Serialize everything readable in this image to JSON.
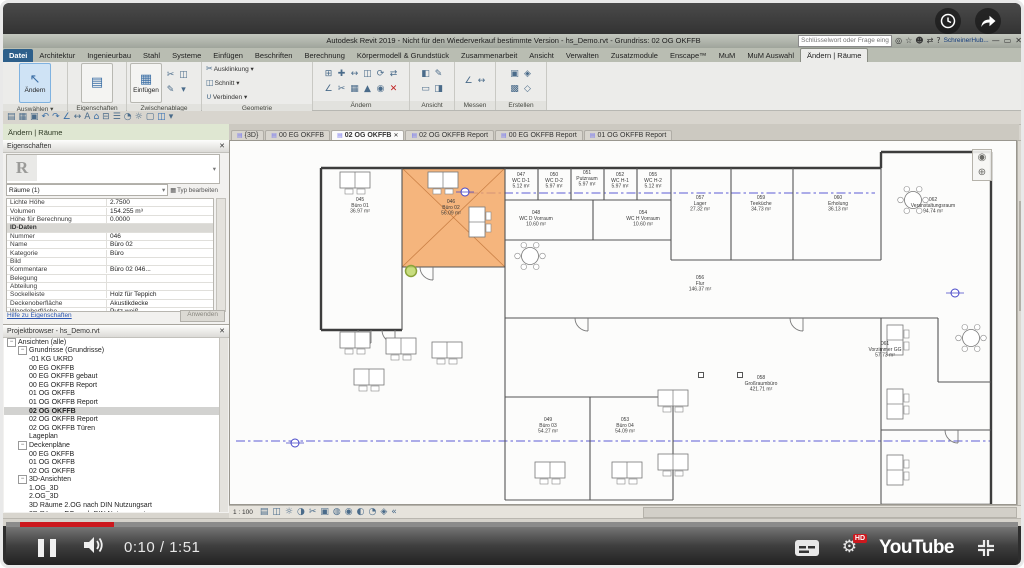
{
  "player": {
    "time": "0:10 / 1:51",
    "brand": "YouTube",
    "hd": "HD",
    "accent": "#cc181e",
    "progress_px": 94
  },
  "titlebar": {
    "title": "Autodesk Revit 2019 - Nicht für den Wiederverkauf bestimmte Version - hs_Demo.rvt - Grundriss: 02 OG OKFFB",
    "search_placeholder": "Schlüsselwort oder Frage eingeben",
    "account_label": "SchreinerHub...",
    "icons": [
      {
        "name": "search-binoculars-icon",
        "glyph": "◎"
      },
      {
        "name": "favorites-icon",
        "glyph": "☆"
      },
      {
        "name": "sign-in-icon",
        "glyph": "☻"
      },
      {
        "name": "cart-icon",
        "glyph": "⇄"
      },
      {
        "name": "help-icon",
        "glyph": "?"
      }
    ],
    "window_controls": [
      {
        "name": "minimize-icon",
        "glyph": "—"
      },
      {
        "name": "restore-icon",
        "glyph": "▭"
      },
      {
        "name": "close-icon",
        "glyph": "✕"
      }
    ]
  },
  "ribbon": {
    "tabs": [
      "Datei",
      "Architektur",
      "Ingenieurbau",
      "Stahl",
      "Systeme",
      "Einfügen",
      "Beschriften",
      "Berechnung",
      "Körpermodell & Grundstück",
      "Zusammenarbeit",
      "Ansicht",
      "Verwalten",
      "Zusatzmodule",
      "Enscape™",
      "MuM",
      "MuM Auswahl",
      "Ändern | Räume"
    ],
    "file_tab": "Datei",
    "active_tab": "Ändern | Räume",
    "big_modify": "Ändern",
    "big_paste": "Einfügen",
    "panel_labels": {
      "select": "Auswählen ▾",
      "properties": "Eigenschaften",
      "clipboard": "Zwischenablage",
      "geometry": "Geometrie",
      "modify": "Ändern",
      "view": "Ansicht",
      "measure": "Messen",
      "create": "Erstellen"
    },
    "geometrie_rows": [
      {
        "glyph": "✂",
        "label": "Ausklinkung ▾"
      },
      {
        "glyph": "◫",
        "label": "Schnitt ▾"
      },
      {
        "glyph": "∪",
        "label": "Verbinden ▾"
      }
    ]
  },
  "qat_icons": [
    {
      "name": "open-icon",
      "glyph": "▤"
    },
    {
      "name": "save-icon",
      "glyph": "▦"
    },
    {
      "name": "print-icon",
      "glyph": "▣"
    },
    {
      "name": "undo-icon",
      "glyph": "↶",
      "color": "#3a6ea5"
    },
    {
      "name": "redo-icon",
      "glyph": "↷",
      "color": "#3a6ea5"
    },
    {
      "name": "measure-icon",
      "glyph": "∠",
      "color": "#3a6ea5"
    },
    {
      "name": "aligned-dimension-icon",
      "glyph": "↔"
    },
    {
      "name": "text-icon",
      "glyph": "A"
    },
    {
      "name": "default-3d-view-icon",
      "glyph": "⌂",
      "color": "#3a6ea5"
    },
    {
      "name": "section-icon",
      "glyph": "⊟"
    },
    {
      "name": "thin-lines-icon",
      "glyph": "☰"
    },
    {
      "name": "render-icon",
      "glyph": "◔"
    },
    {
      "name": "sun-icon",
      "glyph": "☼"
    },
    {
      "name": "close-inactive-icon",
      "glyph": "▢"
    },
    {
      "name": "switch-windows-icon",
      "glyph": "◫",
      "color": "#2d6cb4"
    },
    {
      "name": "user-interface-icon",
      "glyph": "▾"
    }
  ],
  "zwischenablage_icons": [
    {
      "name": "cut-icon",
      "glyph": "✂"
    },
    {
      "name": "copy-to-clipboard-icon",
      "glyph": "◫"
    },
    {
      "name": "match-type-icon",
      "glyph": "✎"
    },
    {
      "name": "paste-options-icon",
      "glyph": "▾"
    }
  ],
  "modify_icons": [
    {
      "name": "align-icon",
      "glyph": "⊞"
    },
    {
      "name": "move-icon",
      "glyph": "✚"
    },
    {
      "name": "offset-icon",
      "glyph": "↔"
    },
    {
      "name": "copy-icon",
      "glyph": "◫"
    },
    {
      "name": "rotate-icon",
      "glyph": "⟳"
    },
    {
      "name": "mirror-icon",
      "glyph": "⇄"
    },
    {
      "name": "trim-icon",
      "glyph": "∠"
    },
    {
      "name": "split-icon",
      "glyph": "✂"
    },
    {
      "name": "array-icon",
      "glyph": "▦"
    },
    {
      "name": "scale-icon",
      "glyph": "▲"
    },
    {
      "name": "pin-icon",
      "glyph": "◉"
    },
    {
      "name": "delete-icon",
      "glyph": "✕",
      "color": "#c02020"
    }
  ],
  "ansicht_icons": [
    {
      "name": "wireframe-icon",
      "glyph": "◧"
    },
    {
      "name": "linework-icon",
      "glyph": "✎"
    },
    {
      "name": "callout-icon",
      "glyph": "▭"
    },
    {
      "name": "view-range-icon",
      "glyph": "◨"
    }
  ],
  "messen_icons": [
    {
      "name": "measure-between-icon",
      "glyph": "∠"
    },
    {
      "name": "dimension-icon",
      "glyph": "↔"
    }
  ],
  "erstellen_icons": [
    {
      "name": "create-group-icon",
      "glyph": "▣"
    },
    {
      "name": "create-similar-icon",
      "glyph": "◈"
    },
    {
      "name": "create-assembly-icon",
      "glyph": "▩"
    },
    {
      "name": "create-parts-icon",
      "glyph": "◇"
    }
  ],
  "options_label": "Ändern | Räume",
  "properties": {
    "header": "Eigenschaften",
    "selector_value": "Räume (1)",
    "edit_type_label": "Typ bearbeiten",
    "rows": [
      {
        "label": "Lichte Höhe",
        "value": "2.7500"
      },
      {
        "label": "Volumen",
        "value": "154.255 m³"
      },
      {
        "label": "Höhe für Berechnung",
        "value": "0.0000"
      },
      {
        "section": "ID-Daten"
      },
      {
        "label": "Nummer",
        "value": "046"
      },
      {
        "label": "Name",
        "value": "Büro 02"
      },
      {
        "label": "Kategorie",
        "value": "Büro"
      },
      {
        "label": "Bild",
        "value": ""
      },
      {
        "label": "Kommentare",
        "value": "Büro 02 046..."
      },
      {
        "label": "Belegung",
        "value": ""
      },
      {
        "label": "Abteilung",
        "value": ""
      },
      {
        "label": "Sockelleiste",
        "value": "Holz für Teppich"
      },
      {
        "label": "Deckenoberfläche",
        "value": "Akustikdecke"
      },
      {
        "label": "Wandoberfläche",
        "value": "Putz weiß"
      },
      {
        "label": "Fußboden",
        "value": "Teppich"
      }
    ],
    "help_link": "Hilfe zu Eigenschaften",
    "apply_label": "Anwenden"
  },
  "project_browser": {
    "header": "Projektbrowser - hs_Demo.rvt",
    "items": [
      {
        "label": "Ansichten (alle)",
        "depth": 0,
        "toggle": true
      },
      {
        "label": "Grundrisse (Grundrisse)",
        "depth": 1,
        "toggle": true
      },
      {
        "label": "-01 KG UKRD",
        "depth": 2
      },
      {
        "label": "00 EG OKFFB",
        "depth": 2
      },
      {
        "label": "00 EG OKFFB gebaut",
        "depth": 2
      },
      {
        "label": "00 EG OKFFB Report",
        "depth": 2
      },
      {
        "label": "01 OG OKFFB",
        "depth": 2
      },
      {
        "label": "01 OG OKFFB Report",
        "depth": 2
      },
      {
        "label": "02 OG OKFFB",
        "depth": 2,
        "selected": true
      },
      {
        "label": "02 OG OKFFB Report",
        "depth": 2
      },
      {
        "label": "02 OG OKFFB Türen",
        "depth": 2
      },
      {
        "label": "Lageplan",
        "depth": 2
      },
      {
        "label": "Deckenpläne",
        "depth": 1,
        "toggle": true
      },
      {
        "label": "00 EG OKFFB",
        "depth": 2
      },
      {
        "label": "01 OG OKFFB",
        "depth": 2
      },
      {
        "label": "02 OG OKFFB",
        "depth": 2
      },
      {
        "label": "3D-Ansichten",
        "depth": 1,
        "toggle": true
      },
      {
        "label": "1.OG_3D",
        "depth": 2
      },
      {
        "label": "2.OG_3D",
        "depth": 2
      },
      {
        "label": "3D Räume 2.OG  nach DIN Nutzungsart",
        "depth": 2
      },
      {
        "label": "3D Räume EG  nach DIN Nutzungsart",
        "depth": 2
      }
    ]
  },
  "view_tabs": {
    "close_glyph": "✕",
    "items": [
      {
        "label": "{3D}"
      },
      {
        "label": "00 EG OKFFB"
      },
      {
        "label": "02 OG OKFFB",
        "active": true
      },
      {
        "label": "02 OG OKFFB Report"
      },
      {
        "label": "00 EG OKFFB Report"
      },
      {
        "label": "01 OG OKFFB Report"
      }
    ]
  },
  "canvas": {
    "scale_label": "1 : 100"
  },
  "view_icons": [
    {
      "name": "detail-level-icon",
      "glyph": "▤"
    },
    {
      "name": "visual-style-icon",
      "glyph": "◫"
    },
    {
      "name": "sun-path-icon",
      "glyph": "☼"
    },
    {
      "name": "shadows-icon",
      "glyph": "◑"
    },
    {
      "name": "crop-view-icon",
      "glyph": "✂"
    },
    {
      "name": "show-crop-icon",
      "glyph": "▣"
    },
    {
      "name": "temporary-hide-icon",
      "glyph": "◍"
    },
    {
      "name": "reveal-hidden-icon",
      "glyph": "◉"
    },
    {
      "name": "worksharing-display-icon",
      "glyph": "◐"
    },
    {
      "name": "temporary-view-icon",
      "glyph": "◔"
    },
    {
      "name": "analysis-icon",
      "glyph": "◈"
    },
    {
      "name": "constraints-icon",
      "glyph": "«"
    }
  ],
  "nav_icons": [
    {
      "name": "steering-wheel-icon",
      "glyph": "◉"
    },
    {
      "name": "zoom-tool-icon",
      "glyph": "⊕"
    }
  ],
  "plan": {
    "highlight": {
      "x": 399,
      "y": 168,
      "w": 103,
      "h": 99
    },
    "walls_outer": [
      [
        318,
        168,
        878,
        168
      ],
      [
        878,
        152,
        878,
        168
      ],
      [
        878,
        152,
        988,
        152
      ],
      [
        988,
        152,
        988,
        505
      ],
      [
        318,
        168,
        318,
        330
      ],
      [
        318,
        330,
        399,
        330
      ],
      [
        878,
        505,
        988,
        505
      ]
    ],
    "walls_inner": [
      [
        399,
        168,
        399,
        330
      ],
      [
        502,
        168,
        502,
        318
      ],
      [
        399,
        267,
        502,
        267
      ],
      [
        535,
        168,
        535,
        200
      ],
      [
        568,
        168,
        568,
        200
      ],
      [
        601,
        168,
        601,
        200
      ],
      [
        634,
        168,
        634,
        200
      ],
      [
        502,
        200,
        668,
        200
      ],
      [
        590,
        200,
        590,
        240
      ],
      [
        502,
        240,
        668,
        240
      ],
      [
        668,
        168,
        668,
        260
      ],
      [
        728,
        168,
        728,
        260
      ],
      [
        790,
        168,
        790,
        260
      ],
      [
        668,
        260,
        878,
        260
      ],
      [
        502,
        318,
        935,
        318
      ],
      [
        502,
        318,
        502,
        397
      ],
      [
        502,
        397,
        670,
        397
      ],
      [
        587,
        397,
        587,
        500
      ],
      [
        670,
        397,
        670,
        500
      ],
      [
        502,
        500,
        670,
        500
      ],
      [
        502,
        397,
        502,
        500
      ],
      [
        878,
        168,
        878,
        260
      ],
      [
        878,
        318,
        878,
        505
      ],
      [
        935,
        318,
        935,
        382
      ],
      [
        935,
        382,
        988,
        382
      ],
      [
        878,
        430,
        988,
        430
      ]
    ],
    "ref_lines": [
      [
        466,
        193,
        872,
        193
      ],
      [
        233,
        441,
        988,
        441
      ]
    ],
    "rooms": [
      {
        "number": "045",
        "name": "Büro 01",
        "area": "36.97 m²",
        "x": 357,
        "y": 206
      },
      {
        "number": "046",
        "name": "Büro 02",
        "area": "56.09 m²",
        "x": 448,
        "y": 208,
        "hl": true
      },
      {
        "number": "047",
        "name": "WC D-1",
        "area": "5.12 m²",
        "x": 518,
        "y": 181
      },
      {
        "number": "050",
        "name": "WC D-2",
        "area": "5.97 m²",
        "x": 551,
        "y": 181
      },
      {
        "number": "051",
        "name": "Putzraum",
        "area": "5.97 m²",
        "x": 584,
        "y": 179
      },
      {
        "number": "052",
        "name": "WC H-1",
        "area": "5.97 m²",
        "x": 617,
        "y": 181
      },
      {
        "number": "055",
        "name": "WC H-2",
        "area": "5.12 m²",
        "x": 650,
        "y": 181
      },
      {
        "number": "048",
        "name": "WC D Vorraum",
        "area": "10.60 m²",
        "x": 533,
        "y": 219
      },
      {
        "number": "054",
        "name": "WC H Vorraum",
        "area": "10.60 m²",
        "x": 640,
        "y": 219
      },
      {
        "number": "057",
        "name": "Lager",
        "area": "27.32 m²",
        "x": 697,
        "y": 204
      },
      {
        "number": "059",
        "name": "Teeküche",
        "area": "34.73 m²",
        "x": 758,
        "y": 204
      },
      {
        "number": "060",
        "name": "Erholung",
        "area": "36.13 m²",
        "x": 835,
        "y": 204
      },
      {
        "number": "062",
        "name": "Veranstaltungsraum",
        "area": "94.74 m²",
        "x": 930,
        "y": 206
      },
      {
        "number": "056",
        "name": "Flur",
        "area": "146.37 m²",
        "x": 697,
        "y": 284
      },
      {
        "number": "058",
        "name": "Großraumbüro",
        "area": "421.71 m²",
        "x": 758,
        "y": 384
      },
      {
        "number": "049",
        "name": "Büro 03",
        "area": "54.27 m²",
        "x": 545,
        "y": 426
      },
      {
        "number": "053",
        "name": "Büro 04",
        "area": "54.09 m²",
        "x": 622,
        "y": 426
      },
      {
        "number": "061",
        "name": "Vorzimmer GG",
        "area": "57.73 m²",
        "x": 882,
        "y": 350
      }
    ],
    "desks": [
      [
        352,
        180,
        "h"
      ],
      [
        440,
        180,
        "h"
      ],
      [
        474,
        222,
        "v"
      ],
      [
        352,
        340,
        "h"
      ],
      [
        398,
        346,
        "h"
      ],
      [
        444,
        350,
        "h"
      ],
      [
        366,
        377,
        "h"
      ],
      [
        547,
        470,
        "h"
      ],
      [
        624,
        470,
        "h"
      ],
      [
        670,
        398,
        "h"
      ],
      [
        670,
        462,
        "h"
      ],
      [
        892,
        340,
        "v"
      ],
      [
        892,
        404,
        "v"
      ],
      [
        892,
        470,
        "v"
      ]
    ],
    "tables": [
      [
        527,
        256
      ],
      [
        910,
        200
      ],
      [
        968,
        338
      ]
    ],
    "columns": [
      [
        698,
        375
      ],
      [
        737,
        375
      ]
    ],
    "doors": [
      [
        368,
        330
      ],
      [
        392,
        330
      ],
      [
        585,
        318
      ],
      [
        800,
        318
      ],
      [
        955,
        430
      ],
      [
        430,
        267
      ]
    ],
    "markers": [
      [
        462,
        192
      ],
      [
        292,
        443
      ],
      [
        952,
        293
      ]
    ],
    "cursor": {
      "x": 408,
      "y": 271
    }
  }
}
